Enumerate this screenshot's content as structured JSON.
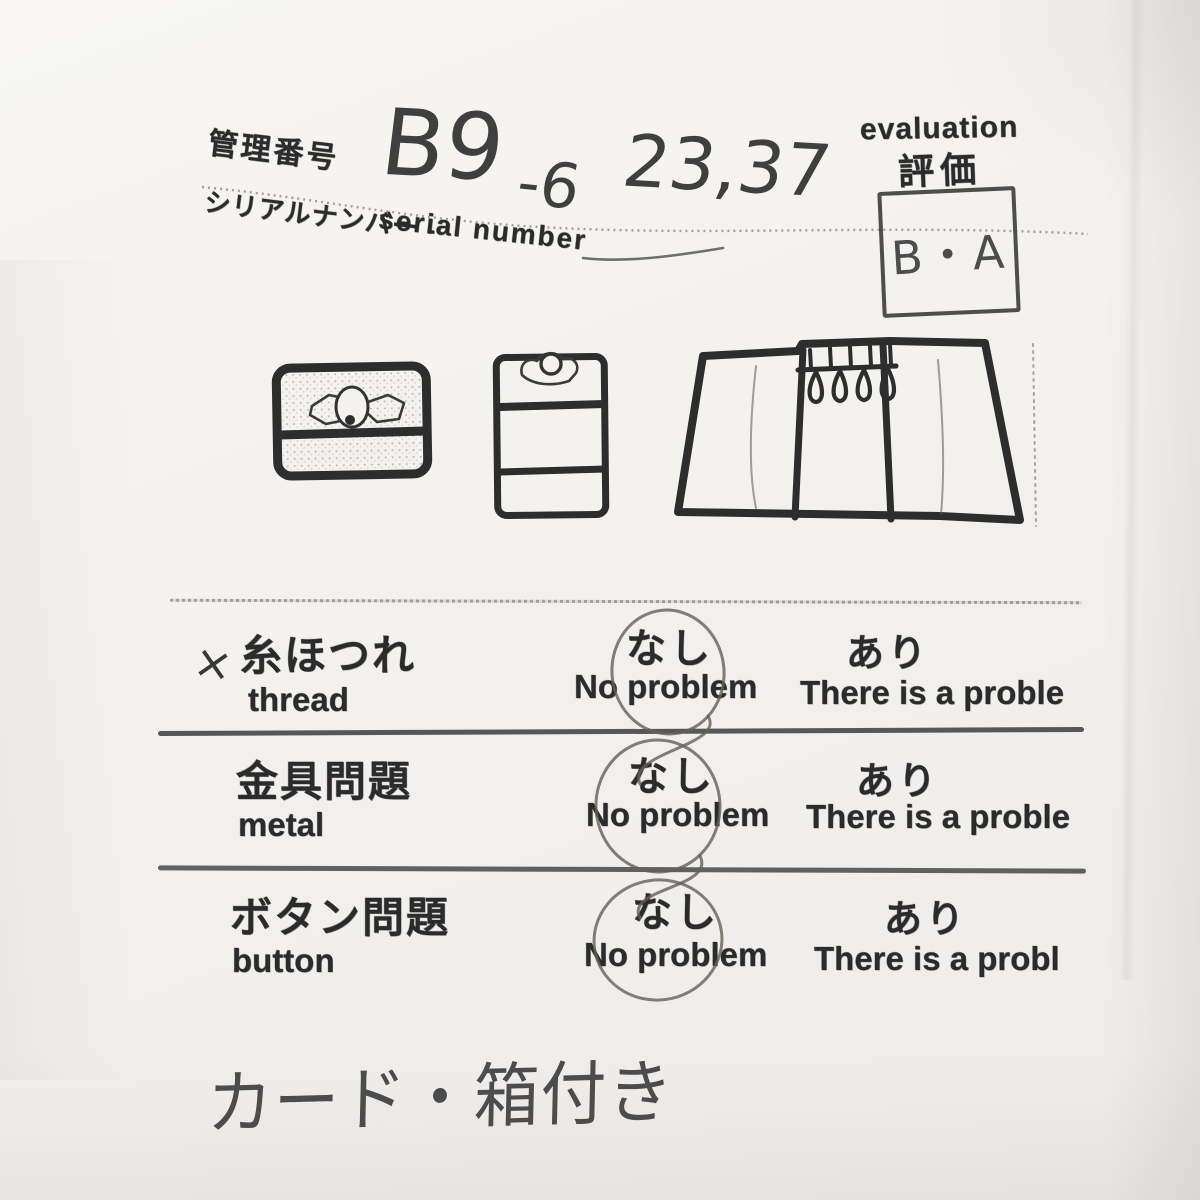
{
  "header": {
    "management_label_jp": "管理番号",
    "management_number_value": "B9-6 23,37",
    "management_number_parts": [
      "B9",
      "-6",
      "23,37"
    ],
    "serial_label_jp": "シリアルナンバー -",
    "serial_label_en": "serial number"
  },
  "evaluation": {
    "label_en": "evaluation",
    "label_jp": "評価",
    "value": "B・A"
  },
  "sketches": {
    "items": [
      "wallet-closed-front-sketch",
      "wallet-vertical-clasp-sketch",
      "key-case-open-sketch"
    ]
  },
  "checklist": {
    "rows": [
      {
        "mark": "×",
        "label_jp": "糸ほつれ",
        "label_en": "thread",
        "no_jp": "なし",
        "no_en": "No problem",
        "yes_jp": "あり",
        "yes_en": "There is a proble",
        "circled_option": "no_problem"
      },
      {
        "mark": "",
        "label_jp": "金具問題",
        "label_en": "metal",
        "no_jp": "なし",
        "no_en": "No problem",
        "yes_jp": "あり",
        "yes_en": "There is a proble",
        "circled_option": "no_problem"
      },
      {
        "mark": "",
        "label_jp": "ボタン問題",
        "label_en": "button",
        "no_jp": "なし",
        "no_en": "No problem",
        "yes_jp": "あり",
        "yes_en": "There is a probl",
        "circled_option": "no_problem"
      }
    ]
  },
  "note": {
    "text": "カード・箱付き"
  },
  "colors": {
    "paper": "#f4f2ef",
    "stamp_ink": "#2b2b2b",
    "pen_ink": "#474747",
    "pencil_circle": "#8d8a82"
  }
}
